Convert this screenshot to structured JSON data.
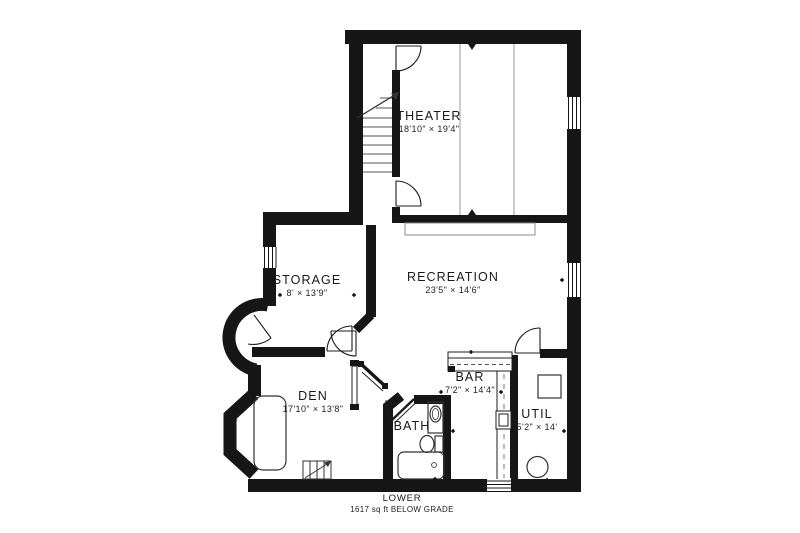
{
  "plan": {
    "rooms": [
      {
        "name": "THEATER",
        "dims": "18'10\" × 19'4\""
      },
      {
        "name": "RECREATION",
        "dims": "23'5\" × 14'6\""
      },
      {
        "name": "STORAGE",
        "dims": "8' × 13'9\""
      },
      {
        "name": "DEN",
        "dims": "17'10\" × 13'8\""
      },
      {
        "name": "BAR",
        "dims": "7'2\" × 14'4\""
      },
      {
        "name": "BATH",
        "dims": ""
      },
      {
        "name": "UTIL",
        "dims": "5'2\" × 14'"
      }
    ],
    "footer": {
      "level": "LOWER",
      "area": "1617 sq ft BELOW GRADE"
    },
    "colors": {
      "wall": "#161616",
      "line": "#1c1c1c",
      "light_line": "#8c8c8c",
      "background": "#ffffff"
    }
  }
}
